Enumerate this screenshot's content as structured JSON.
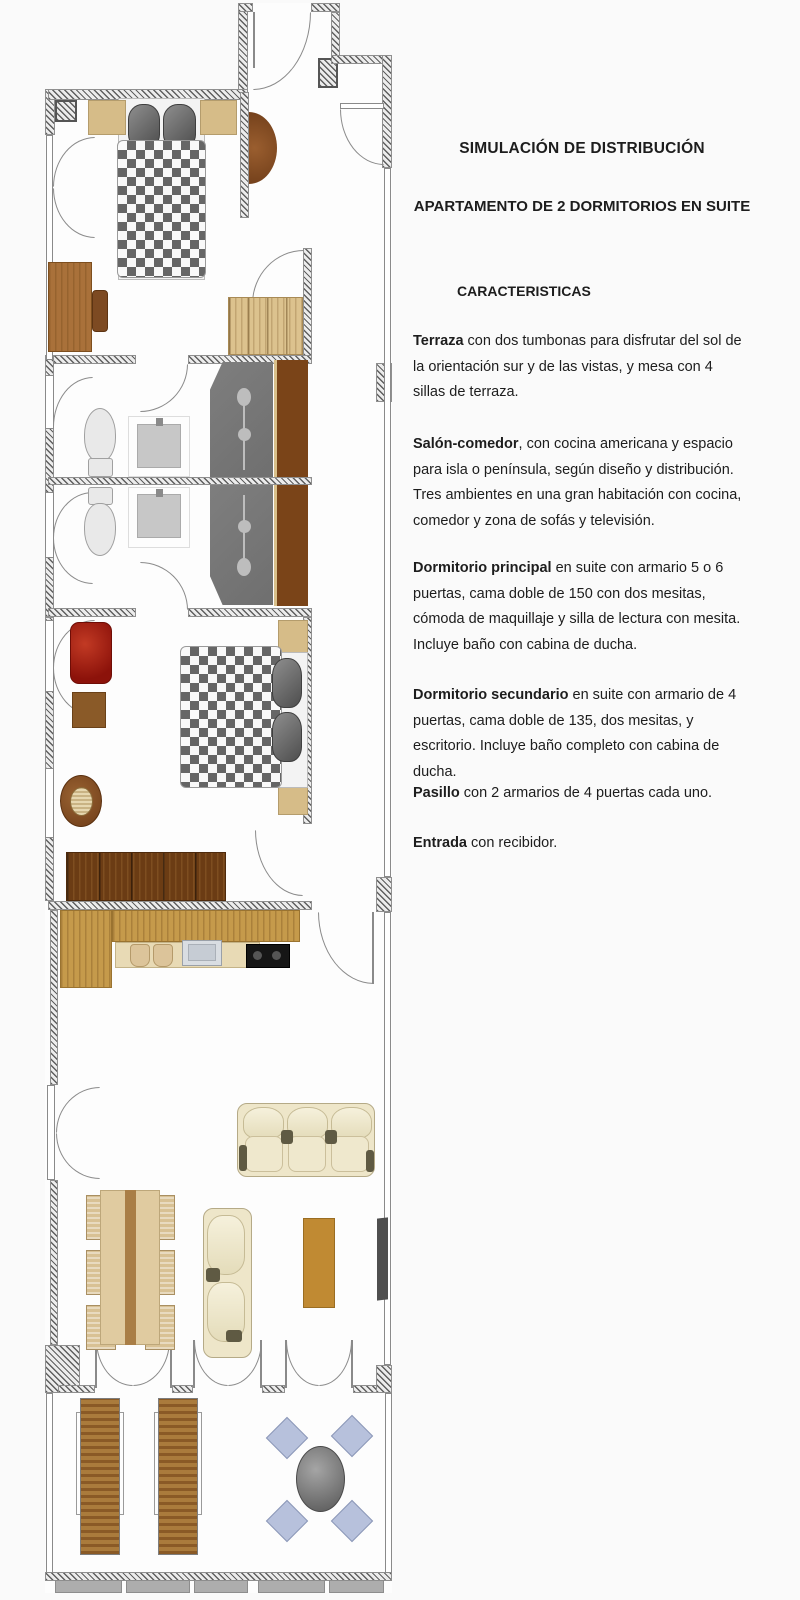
{
  "description": {
    "title": "SIMULACIÓN DE DISTRIBUCIÓN",
    "subtitle": "APARTAMENTO DE 2 DORMITORIOS EN SUITE",
    "section_heading": "CARACTERISTICAS",
    "paragraphs": [
      {
        "lead": "Terraza",
        "rest": " con dos tumbonas para disfrutar del sol de la orientación sur y de las vistas, y mesa con 4 sillas de terraza."
      },
      {
        "lead": "Salón-comedor",
        "rest": ", con cocina americana y espacio para isla o península, según diseño y distribución. Tres ambientes en una gran habitación con cocina, comedor y zona de sofás y televisión."
      },
      {
        "lead": "Dormitorio principal",
        "rest": " en suite con armario 5 o 6 puertas, cama doble de 150 con dos mesitas, cómoda de maquillaje y silla de lectura con mesita. Incluye baño con cabina de ducha."
      },
      {
        "lead": "Dormitorio secundario",
        "rest": " en suite con armario de 4 puertas, cama doble de 135, dos mesitas, y escritorio. Incluye baño completo con cabina de ducha."
      },
      {
        "lead": "Pasillo",
        "rest": " con 2 armarios de 4 puertas cada uno."
      },
      {
        "lead": "Entrada",
        "rest": " con recibidor."
      }
    ]
  },
  "colors": {
    "page_bg": "#fafafa",
    "floor": "#fdfdfd",
    "wall_dark": "#5f5f5f",
    "wall_light": "#ececec",
    "line": "#8a8a8a",
    "checker_dark": "#666666",
    "checker_light": "#f9f9f9",
    "tan": "#d6bc88",
    "wood": "#a9713a",
    "wood_dark": "#7a4418",
    "wood_deep": "#6b3c14",
    "wardrobe_light": "#dcc28e",
    "kitchen_wood": "#c59a4b",
    "cabinet": "#e8dab5",
    "sink": "#d9dde2",
    "stove": "#161616",
    "cream": "#eee6c9",
    "sofa_accent": "#5f5a43",
    "ochre": "#c08a33",
    "red_chair": "#9a150b",
    "shower": "#6f6f6f",
    "fixture": "#bdbdbd",
    "toilet": "#e9e9e9",
    "terrace_chair": "#b7c1dc",
    "terrace_table": "#7e7e7e",
    "lounger_dark": "#8a5a26",
    "lounger_light": "#aa7b3c",
    "rail_gray": "#adadad",
    "text": "#1d1d1d"
  }
}
